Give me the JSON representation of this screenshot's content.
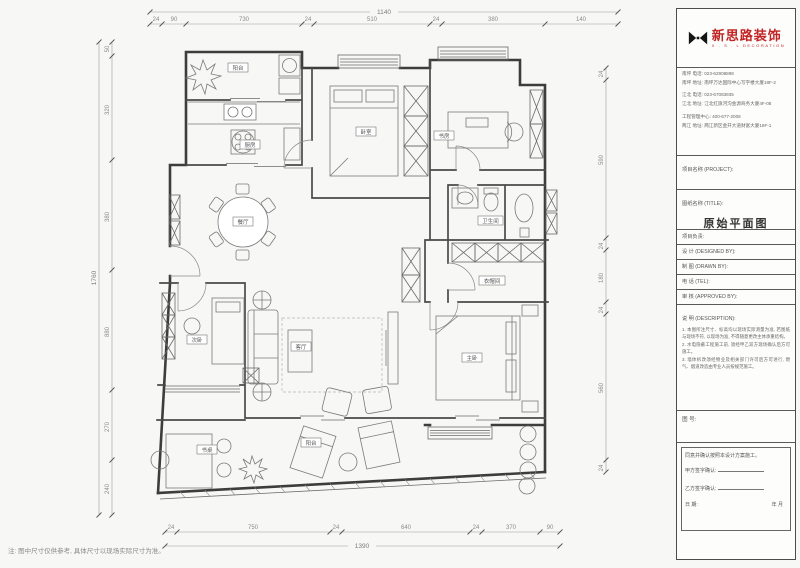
{
  "note_bottom": "注: 图中尺寸仅供参考, 具体尺寸以现场实际尺寸为准。",
  "logo": {
    "brand": "新思路装饰",
    "sub": "X . S . L   DECORATION"
  },
  "contact": {
    "lines": [
      "南坪 电话: 023-62908898",
      "南坪 地址: 南坪万达国际中心写字楼大厦18F-2",
      "江北 电话: 023-67083935",
      "江北 地址: 江北红旗河沟金源商务大厦4F-08",
      "工程管理中心: 400-677-2008",
      "两江 地址: 两江新区金开大道财富大厦18F-1"
    ]
  },
  "titleblock": {
    "project_label": "项目名称 (PROJECT):",
    "title_label": "图纸名称 (TITLE):",
    "drawing_name": "原始平面图",
    "lead_label": "项目负责:",
    "design_label": "设 计 (DESIGNED BY):",
    "draft_label": "制 图 (DRAWN BY):",
    "tel_label": "电 话 (TEL):",
    "approve_label": "审 核 (APPROVED BY):",
    "desc_label": "说 明 (DESCRIPTION):",
    "notes": [
      "1. 本图所注尺寸、标高均以现场实际测量为准, 若图纸与现场不符, 以现场为准, 不得随意更改主体承重结构。",
      "2. 水电隐蔽工程施工前, 须经甲乙双方现场确认后方可施工。",
      "3. 墙体拆改须经物业及相关部门许可后方可进行, 燃气、烟道改造由专业人员按规范施工。"
    ],
    "figno_label": "图 号:",
    "confirm": {
      "statement": "同意并确认按照本设计方案施工。",
      "party_a": "甲方签字确认:",
      "party_b": "乙方签字确认:",
      "date_label": "日        期:",
      "date_value": "年        月"
    }
  },
  "rooms": {
    "balcony_top": "阳台",
    "kitchen": "厨房",
    "dining": "餐厅",
    "bedroom2": "卧室",
    "study": "书房",
    "bath": "卫生间",
    "closet": "衣帽间",
    "master": "主卧",
    "living": "客厅",
    "bedroom3": "次卧",
    "balcony_bottom": "阳台",
    "desk": "书桌"
  },
  "dims": {
    "top": {
      "overall": "1140",
      "labels": [
        "24",
        "90",
        "730",
        "24",
        "510",
        "24",
        "380",
        "140"
      ]
    },
    "bottom": {
      "overall": "1390",
      "labels": [
        "24",
        "750",
        "24",
        "640",
        "24",
        "370",
        "90"
      ]
    },
    "left": {
      "overall": "1760",
      "labels": [
        "50",
        "320",
        "380",
        "880",
        "270",
        "240"
      ]
    },
    "right": {
      "labels": [
        "24",
        "590",
        "24",
        "180",
        "24",
        "560",
        "24"
      ]
    }
  }
}
